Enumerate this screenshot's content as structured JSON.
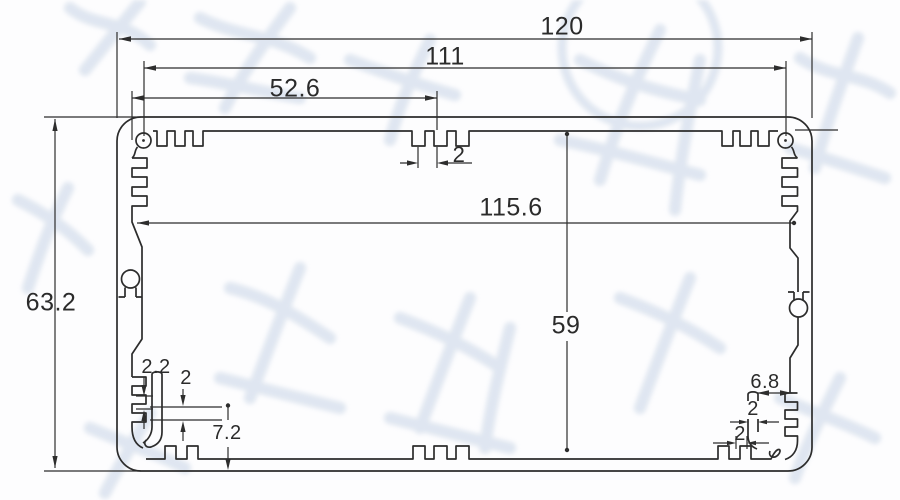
{
  "dimensions": {
    "overall_width": "120",
    "mount_spacing": "111",
    "slot_offset": "52.6",
    "top_slot_width": "2",
    "inner_width": "115.6",
    "inner_height": "59",
    "overall_height": "63.2",
    "left_boss_pitch": "2.2",
    "left_boss_gap": "2",
    "left_boss_height": "7.2",
    "right_boss_width": "6.8",
    "right_boss_wall": "2",
    "right_boss_slot": "2"
  },
  "colors": {
    "line": "#2c2c2c",
    "text": "#2b2b2b",
    "watermark": "#c6d3e6",
    "background": "#ffffff"
  }
}
